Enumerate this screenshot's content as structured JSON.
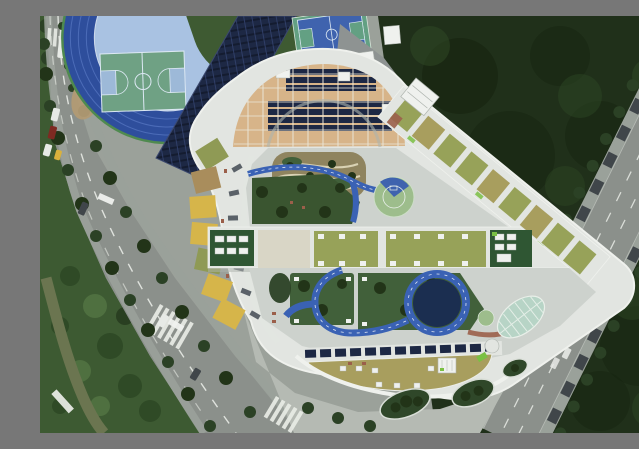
{
  "image": {
    "type": "aerial-photograph",
    "subject": "top-down drone view of a school campus: blue athletics track with basketball court, rooftop solar arrays, white rounded triangular school building with roof gardens, blue play paths and courtyards, tree-lined roads and dense green fields"
  },
  "palette": {
    "base": "#9ba19a",
    "veg_dark": "#20301a",
    "veg_shadow": "#16230f",
    "veg_light": "#2f4a26",
    "veg_scrub": "#3d5a32",
    "scrub_light": "#4f7040",
    "road": "#8b908b",
    "road_side": "#9aa19a",
    "road_line": "#e8ebe5",
    "canal": "#6b7550",
    "dirt": "#b29b74",
    "track_blue": "#2e4e9c",
    "track_lane": "#4c6cb8",
    "track_trim": "#4f8a4f",
    "dzone": "#a9c2e2",
    "field_green": "#3e5a32",
    "court_green": "#6fa184",
    "court_key": "#9db9d8",
    "court_line": "#dce8f3",
    "topcourt_blue": "#3f63ae",
    "topcourt_green": "#63a083",
    "solar": "#1d2844",
    "solar_row": "#31406b",
    "solar_gap": "#141c30",
    "bldg_white": "#e2e5e1",
    "rim_white": "#eff1ed",
    "shade": "#aeb4ae",
    "roof_tan": "#d7b489",
    "roof_grid": "#eae4d5",
    "seg_yellow": "#d6b54a",
    "seg_olive": "#8f9a55",
    "seg_tan": "#a98d5c",
    "lawn_dark": "#3a5530",
    "lawn_mid": "#41603a",
    "grass_olive": "#97a259",
    "grass_dry": "#a89e5e",
    "path_blue": "#3a62b4",
    "navy": "#1b2e50",
    "circle_green": "#9dbd8c",
    "hvac_green": "#2f5633",
    "unit_white": "#eff1ee",
    "plaza_tan": "#d9d6c6",
    "concrete": "#cdd2cd",
    "plaza_gray": "#b5bab3",
    "garden_tan": "#8f845f",
    "garden_path": "#d9d2b4",
    "tree": "#2b4125",
    "tree_dark": "#223418",
    "island_green": "#2f4729",
    "ghouse": "#b7d4c6",
    "ghouse_rib": "#e4eee7",
    "brick": "#9b5f4a",
    "lime": "#7ac043",
    "car_white": "#e7eae6",
    "car_red": "#7e2a22",
    "car_yellow": "#d9b13c",
    "car_blue": "#2b3f8e",
    "car_dark": "#40464a"
  },
  "scene": {
    "regions": [
      {
        "name": "athletics-track",
        "color": "track_blue"
      },
      {
        "name": "track-infield",
        "color": "field_green"
      },
      {
        "name": "dzone-basketball-court",
        "color": "court_green"
      },
      {
        "name": "north-basketball-court",
        "color": "topcourt_blue"
      },
      {
        "name": "gym-solar-roof",
        "color": "solar"
      },
      {
        "name": "school-building",
        "color": "bldg_white"
      },
      {
        "name": "arch-roof-solar-rows",
        "color": "roof_tan"
      },
      {
        "name": "radial-roof-segments",
        "color": "seg_yellow"
      },
      {
        "name": "upper-courtyard-garden",
        "color": "garden_tan"
      },
      {
        "name": "blue-play-paths",
        "color": "path_blue"
      },
      {
        "name": "half-court-circle",
        "color": "circle_green"
      },
      {
        "name": "green-roof-bars",
        "color": "grass_olive"
      },
      {
        "name": "lower-courtyard-ring",
        "color": "navy"
      },
      {
        "name": "bottom-crescent-roof",
        "color": "grass_dry"
      },
      {
        "name": "greenhouse-dome",
        "color": "ghouse"
      },
      {
        "name": "west-road",
        "color": "road"
      },
      {
        "name": "east-road",
        "color": "road"
      },
      {
        "name": "canal",
        "color": "canal"
      },
      {
        "name": "east-vegetation",
        "color": "veg_dark"
      },
      {
        "name": "southwest-scrub",
        "color": "veg_scrub"
      },
      {
        "name": "south-plaza",
        "color": "plaza_gray"
      }
    ]
  }
}
